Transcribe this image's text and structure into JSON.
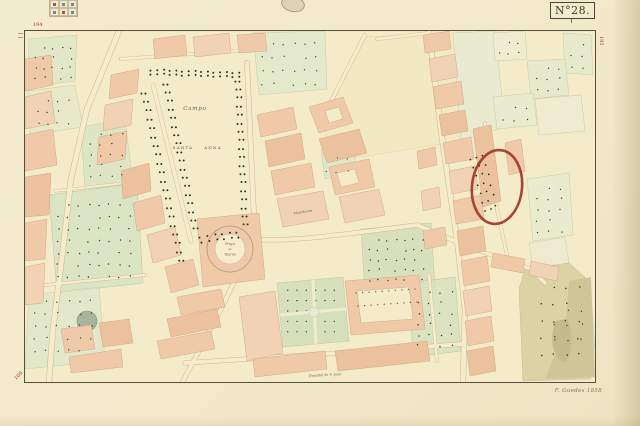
{
  "sheet": {
    "number_label": "N°28.",
    "engraver_signature": "F. Guedes 1858",
    "edge_refs": {
      "top_left": "194",
      "right_top": "195",
      "bottom_left": "109"
    }
  },
  "map": {
    "labels": {
      "campo": "Campo",
      "santa": "SANTA",
      "anna": "ANNA",
      "bullring": [
        "Praça",
        "de",
        "Touros"
      ],
      "matadouro": "Matadouro",
      "hospital": "Hospital de S. José"
    },
    "annotation": {
      "shape": "hand-drawn red oval",
      "color": "#9c3428"
    },
    "colors": {
      "paper": "#f4ebc9",
      "road": "#f6eccb",
      "building_block": "#efc9a8",
      "garden_green": "#dce6c6",
      "hillside_olive": "#dbd2a6",
      "tree_dot": "#2c3420",
      "frame_ink": "#55503d",
      "edge_ref_red": "#a03a2c"
    }
  }
}
